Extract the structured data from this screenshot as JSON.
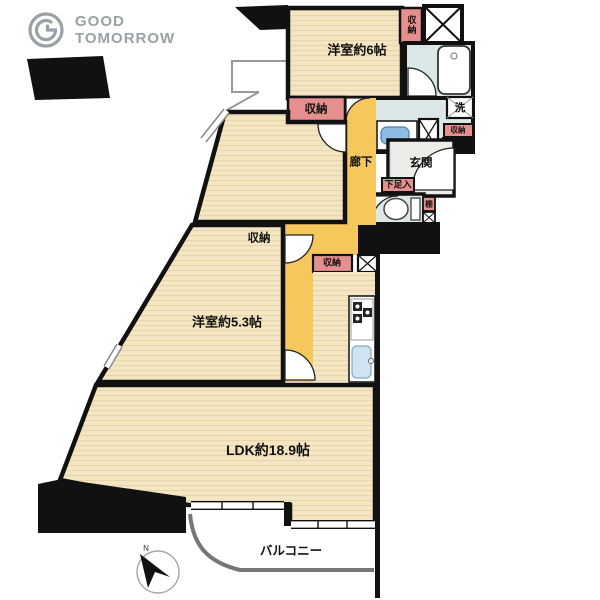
{
  "logo": {
    "line1": "GOOD",
    "line2": "TOMORROW",
    "color": "#98a2a5"
  },
  "labels": {
    "bedroom6": "洋室約6帖",
    "bedroom53": "洋室約5.3帖",
    "ldk": "LDK約18.9帖",
    "balcony": "バルコニー",
    "corridor": "廊下",
    "entrance": "玄関",
    "shoe_box": "下足入",
    "closet": "収納",
    "laundry": "洗",
    "shelf": "棚",
    "north": "N"
  },
  "colors": {
    "wall": "#111111",
    "wood_floor": "#f4e6c3",
    "wood_stripe": "#e7d3a6",
    "corridor_yellow": "#f6c75c",
    "closet_pink": "#e68f8f",
    "wet_area_blue": "#dce8e7",
    "entrance_gray": "#edece8",
    "sink_blue": "#8fbbe3",
    "fence_gray": "#777777"
  }
}
